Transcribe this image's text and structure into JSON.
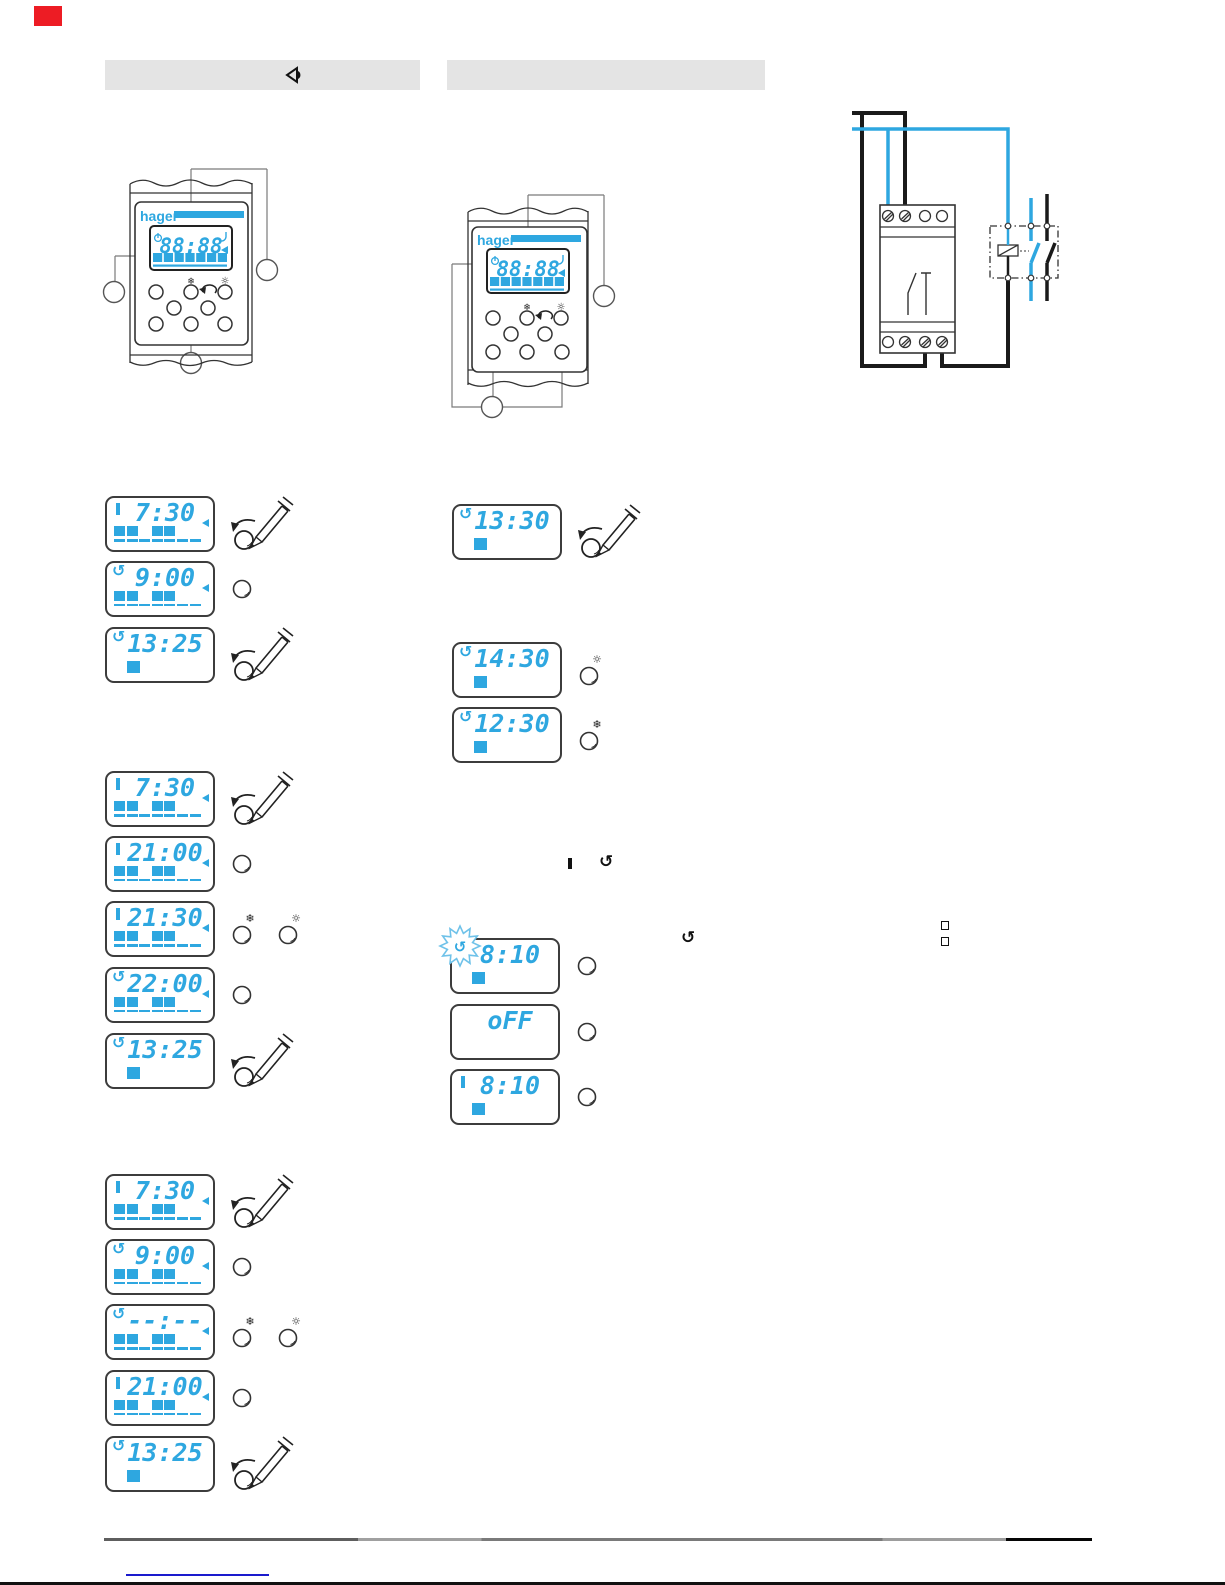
{
  "brand": "hager",
  "colors": {
    "lcd_blue": "#2ea7e0",
    "marker_red": "#ed1c24",
    "link_blue": "#1a1acd",
    "bar_gray": "#e4e4e4"
  },
  "glyphs": {
    "cycle": "↺",
    "snow": "❄",
    "sun": "☼"
  },
  "header": {
    "bar1_icon": "manual-override-arrow-icon",
    "bar2_icon": ""
  },
  "devices": [
    {
      "logo": "hager",
      "display": "88:88"
    },
    {
      "logo": "hager",
      "display": "88:88"
    }
  ],
  "wiring_diagram": {
    "parts": [
      "timer-module",
      "screw-terminals",
      "supply-wires",
      "contactor-box",
      "relay-coil",
      "switch-contacts"
    ]
  },
  "inline_symbols": [
    "on-bar",
    "cycle-arrow",
    "cycle-arrow",
    "bullet-square",
    "bullet-square"
  ],
  "lcd_groups": {
    "groupA": {
      "steps": [
        {
          "time": "7:30",
          "mode": "on",
          "days": [
            1,
            1,
            0,
            1,
            1,
            0,
            0
          ],
          "day_scale": true,
          "triangle": true,
          "actions": [
            "knob-pencil"
          ]
        },
        {
          "time": "9:00",
          "mode": "cycle",
          "days": [
            1,
            1,
            0,
            1,
            1,
            0,
            0
          ],
          "day_scale": true,
          "triangle": true,
          "actions": [
            "press"
          ]
        },
        {
          "time": "13:25",
          "mode": "cycle",
          "single_block": true,
          "actions": [
            "knob-pencil"
          ]
        }
      ]
    },
    "groupB": {
      "steps": [
        {
          "time": "7:30",
          "mode": "on",
          "days": [
            1,
            1,
            0,
            1,
            1,
            0,
            0
          ],
          "day_scale": true,
          "triangle": true,
          "actions": [
            "knob-pencil"
          ]
        },
        {
          "time": "21:00",
          "mode": "on",
          "days": [
            1,
            1,
            0,
            1,
            1,
            0,
            0
          ],
          "day_scale": true,
          "triangle": true,
          "actions": [
            "press"
          ]
        },
        {
          "time": "21:30",
          "mode": "on",
          "days": [
            1,
            1,
            0,
            1,
            1,
            0,
            0
          ],
          "day_scale": true,
          "triangle": true,
          "actions": [
            "snow",
            "sun"
          ]
        },
        {
          "time": "22:00",
          "mode": "cycle",
          "days": [
            1,
            1,
            0,
            1,
            1,
            0,
            0
          ],
          "day_scale": true,
          "triangle": true,
          "actions": [
            "press"
          ]
        },
        {
          "time": "13:25",
          "mode": "cycle",
          "single_block": true,
          "actions": [
            "knob-pencil"
          ]
        }
      ]
    },
    "groupC": {
      "steps": [
        {
          "time": "7:30",
          "mode": "on",
          "days": [
            1,
            1,
            0,
            1,
            1,
            0,
            0
          ],
          "day_scale": true,
          "triangle": true,
          "actions": [
            "knob-pencil"
          ]
        },
        {
          "time": "9:00",
          "mode": "cycle",
          "days": [
            1,
            1,
            0,
            1,
            1,
            0,
            0
          ],
          "day_scale": true,
          "triangle": true,
          "actions": [
            "press"
          ]
        },
        {
          "time": "--:--",
          "mode": "cycle",
          "days": [
            1,
            1,
            0,
            1,
            1,
            0,
            0
          ],
          "day_scale": true,
          "triangle": true,
          "actions": [
            "snow",
            "sun"
          ]
        },
        {
          "time": "21:00",
          "mode": "on",
          "days": [
            1,
            1,
            0,
            1,
            1,
            0,
            0
          ],
          "day_scale": true,
          "triangle": true,
          "actions": [
            "press"
          ]
        },
        {
          "time": "13:25",
          "mode": "cycle",
          "single_block": true,
          "actions": [
            "knob-pencil"
          ]
        }
      ]
    },
    "groupM": {
      "steps": [
        {
          "time": "13:30",
          "mode": "cycle",
          "single_block": true,
          "actions": [
            "knob-pencil"
          ]
        },
        {
          "time": "14:30",
          "mode": "cycle",
          "single_block": true,
          "actions": [
            "sun"
          ]
        },
        {
          "time": "12:30",
          "mode": "cycle",
          "single_block": true,
          "actions": [
            "snow"
          ]
        }
      ]
    },
    "groupN": {
      "steps": [
        {
          "time": "8:10",
          "mode": "none",
          "flash": true,
          "single_block": true,
          "actions": [
            "press"
          ]
        },
        {
          "time": "oFF",
          "mode": "none",
          "actions": [
            "press"
          ]
        },
        {
          "time": "8:10",
          "mode": "on",
          "single_block": true,
          "actions": [
            "press"
          ]
        }
      ]
    }
  }
}
